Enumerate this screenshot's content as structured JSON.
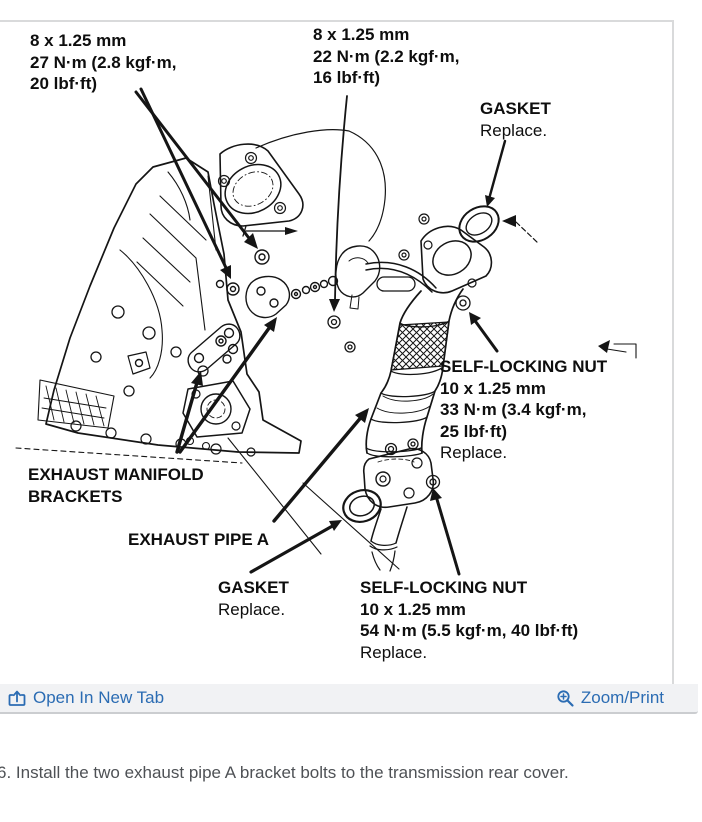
{
  "diagram": {
    "ink_color": "#151515",
    "callouts": {
      "bolt_upper_left": {
        "lines": [
          "8 x 1.25 mm",
          "27 N·m (2.8 kgf·m,",
          "20 lbf·ft)"
        ]
      },
      "bolt_upper_mid": {
        "lines": [
          "8 x 1.25 mm",
          "22 N·m (2.2 kgf·m,",
          "16 lbf·ft)"
        ]
      },
      "gasket_top": {
        "title": "GASKET",
        "note": "Replace."
      },
      "self_locking_nut_upper": {
        "title": "SELF-LOCKING NUT",
        "specs": [
          "10 x 1.25 mm",
          "33 N·m (3.4 kgf·m,",
          "25 lbf·ft)"
        ],
        "note": "Replace."
      },
      "exhaust_manifold_brackets": {
        "lines": [
          "EXHAUST MANIFOLD",
          "BRACKETS"
        ]
      },
      "exhaust_pipe_a": {
        "title": "EXHAUST PIPE A"
      },
      "gasket_bottom": {
        "title": "GASKET",
        "note": "Replace."
      },
      "self_locking_nut_lower": {
        "title": "SELF-LOCKING NUT",
        "specs": [
          "10 x 1.25 mm",
          "54 N·m (5.5 kgf·m, 40 lbf·ft)"
        ],
        "note": "Replace."
      }
    }
  },
  "toolbar": {
    "open_in_new_tab": "Open In New Tab",
    "zoom_print": "Zoom/Print",
    "link_color": "#2b6cb3",
    "bar_background": "#f1f2f4",
    "icons": {
      "left": "open-in-new-tab-icon",
      "right": "zoom-in-magnifier-icon"
    }
  },
  "caption": {
    "text": "6. Install the two exhaust pipe A bracket bolts to the transmission rear cover."
  }
}
